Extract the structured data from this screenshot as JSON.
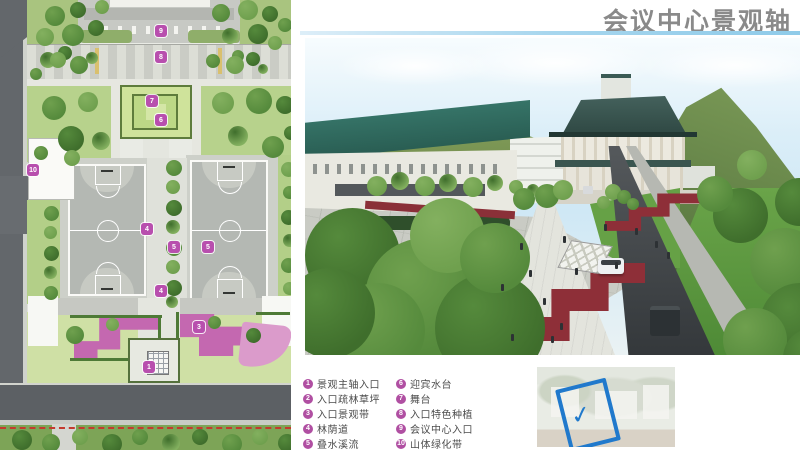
{
  "header": {
    "title": "会议中心景观轴"
  },
  "colors": {
    "title": "#8a8a8a",
    "divider_blue": "#8fcbe9",
    "legend_badge": "#b04fa2",
    "plan_marker": "#b84fae",
    "boundary_red": "#c43b2e",
    "locator_frame": "#2079cc"
  },
  "legend": {
    "badge_color": "#b04fa2",
    "left_column": [
      {
        "num": "1",
        "label": "景观主轴入口"
      },
      {
        "num": "2",
        "label": "入口疏林草坪"
      },
      {
        "num": "3",
        "label": "入口景观带"
      },
      {
        "num": "4",
        "label": "林荫道"
      },
      {
        "num": "5",
        "label": "叠水溪流"
      }
    ],
    "right_column": [
      {
        "num": "6",
        "label": "迎宾水台"
      },
      {
        "num": "7",
        "label": "舞台"
      },
      {
        "num": "8",
        "label": "入口特色种植"
      },
      {
        "num": "9",
        "label": "会议中心入口"
      },
      {
        "num": "10",
        "label": "山体绿化带"
      }
    ]
  },
  "plan": {
    "marker_color": "#b84fae",
    "markers": [
      {
        "num": "9",
        "x": 161,
        "y": 31
      },
      {
        "num": "8",
        "x": 161,
        "y": 57
      },
      {
        "num": "7",
        "x": 152,
        "y": 101
      },
      {
        "num": "6",
        "x": 161,
        "y": 120
      },
      {
        "num": "10",
        "x": 33,
        "y": 170
      },
      {
        "num": "4",
        "x": 147,
        "y": 229
      },
      {
        "num": "5",
        "x": 174,
        "y": 247
      },
      {
        "num": "5",
        "x": 208,
        "y": 247
      },
      {
        "num": "4",
        "x": 161,
        "y": 291
      },
      {
        "num": "3",
        "x": 199,
        "y": 327
      },
      {
        "num": "1",
        "x": 149,
        "y": 367
      }
    ]
  },
  "locator": {
    "checkmark": "✓"
  }
}
